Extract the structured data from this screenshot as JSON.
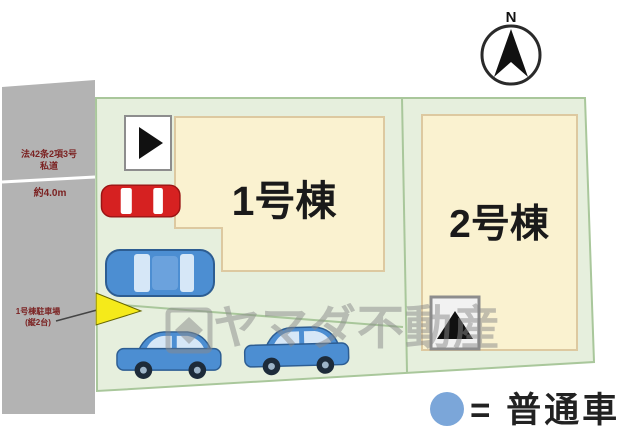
{
  "colors": {
    "road_gray": "#b3b3b3",
    "plot_green": "#e6efdd",
    "plot_border": "#a9c79b",
    "building_cream": "#faf2d0",
    "building_border": "#ddc9a0",
    "car_red": "#d62121",
    "car_blue": "#4c8ed2",
    "marker_yellow": "#f5ea1a",
    "legend_blue": "#7ba6d9",
    "watermark_gray": "#8a8a8a",
    "road_text_red": "#7b2222"
  },
  "icons": {
    "compass": "north-arrow-in-circle",
    "entrance_marker_1": "right-triangle-in-square",
    "entrance_marker_2": "up-triangle-in-square",
    "legend_symbol": "blue-circle"
  },
  "compass": {
    "label": "N"
  },
  "road": {
    "street_line1": "法42条2項3号",
    "street_line2": "私道",
    "width_label": "約4.0m",
    "note_line1": "1号棟駐車場",
    "note_line2": "(縦2台)"
  },
  "buildings": [
    {
      "label": "1号棟"
    },
    {
      "label": "2号棟"
    }
  ],
  "watermark": {
    "text": "ヤマダ不動産"
  },
  "legend": {
    "label": "= 普通車"
  }
}
